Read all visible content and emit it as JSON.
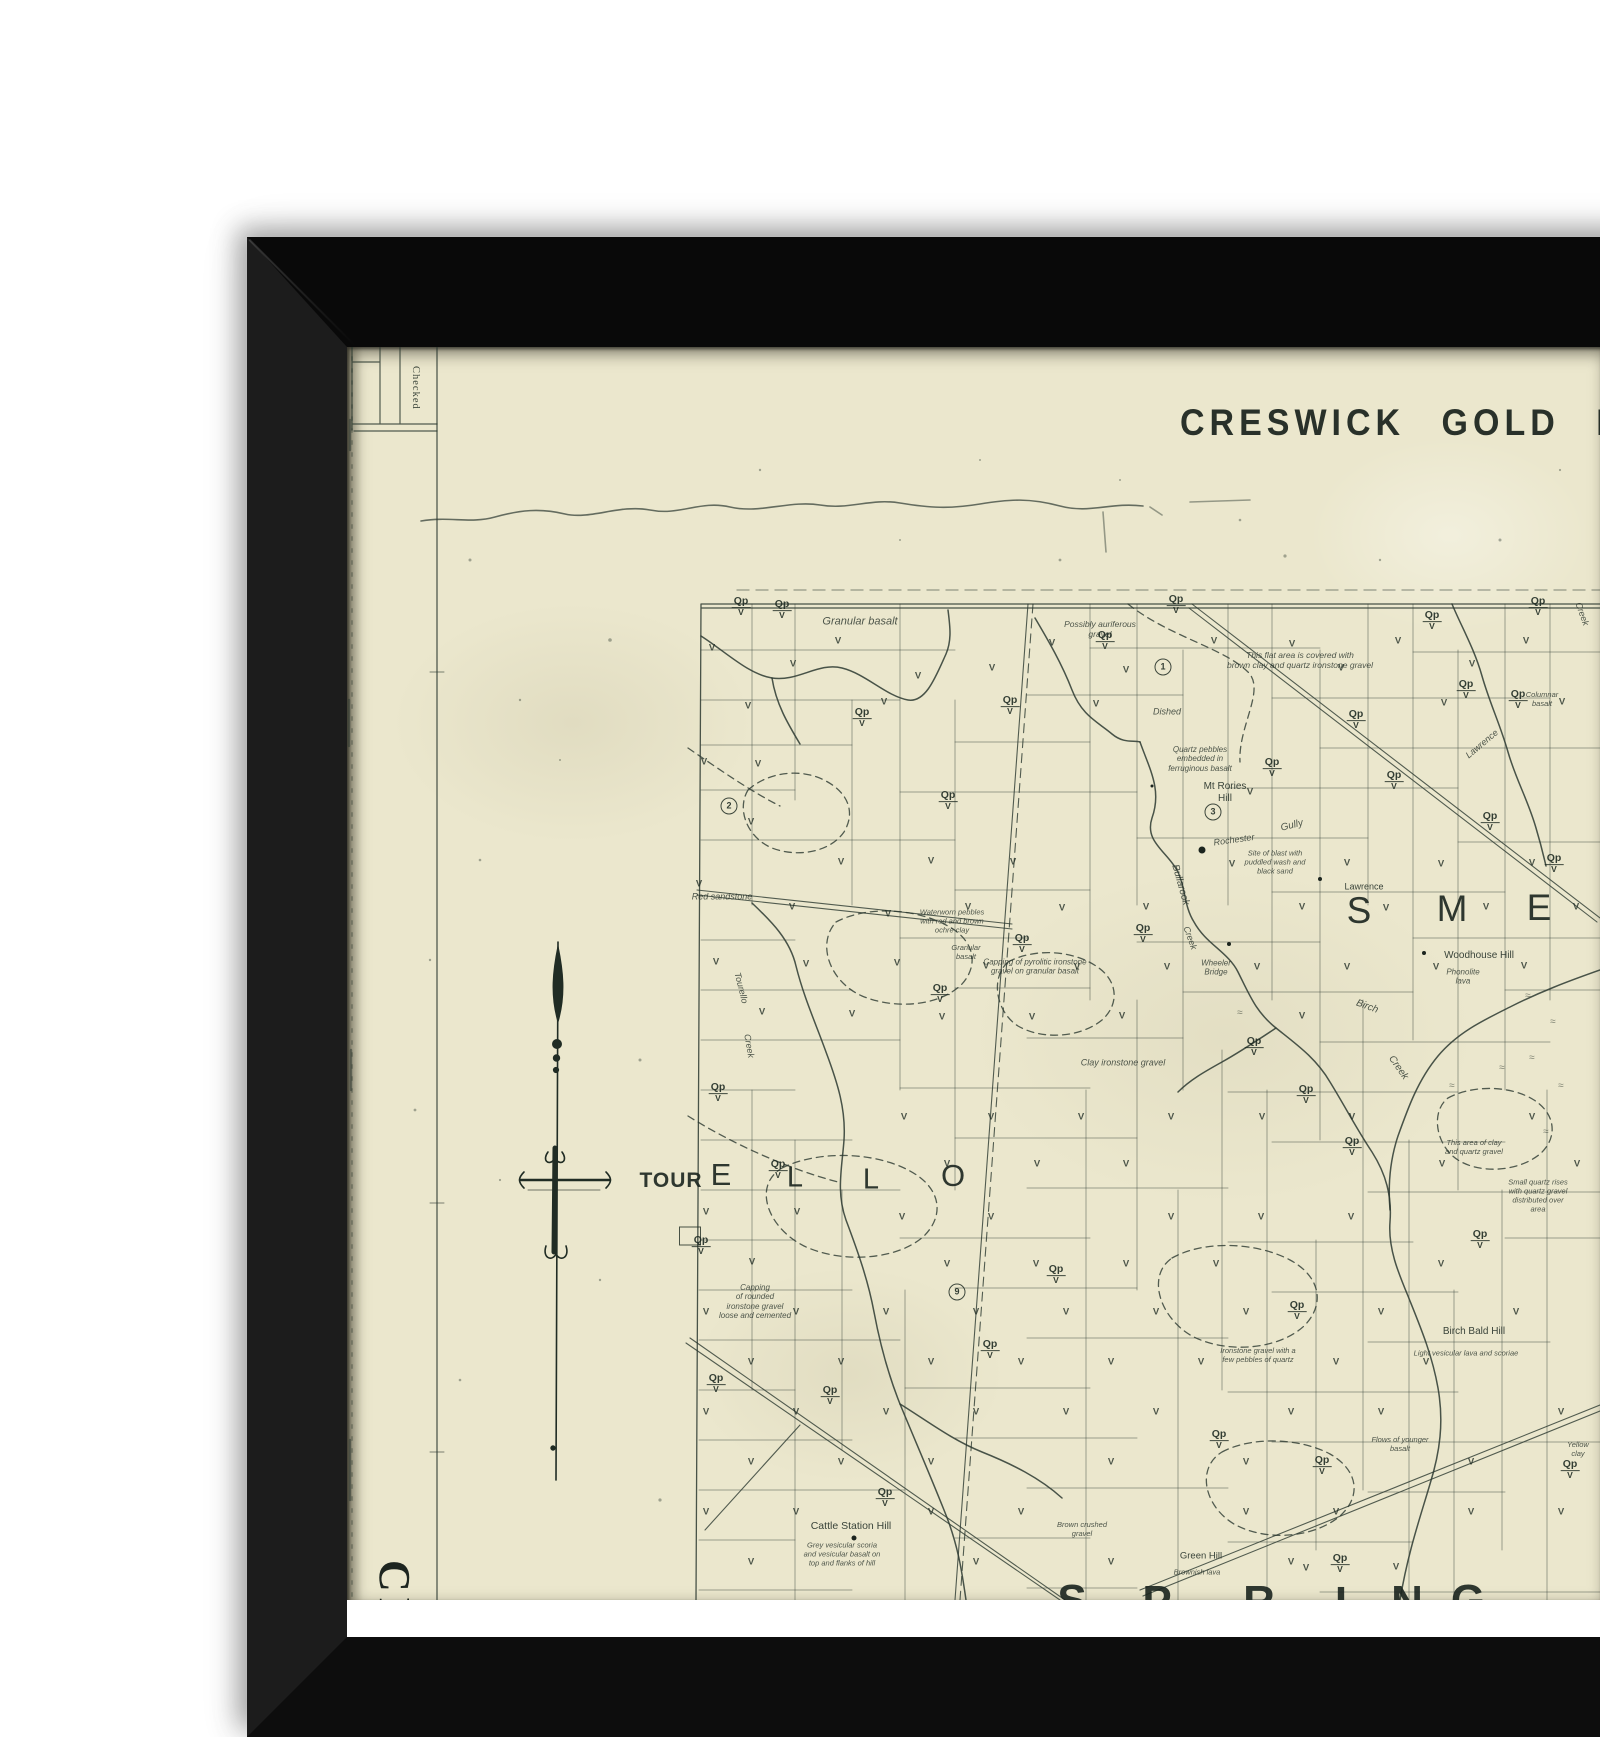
{
  "scene": {
    "background_color": "#ffffff",
    "frame_color": "#0d0d0d",
    "paper_color": "#ebe7cd",
    "ink_color": "#26332a"
  },
  "map": {
    "title": "CRESWICK GOLD FIELD",
    "margin_note": "Checked",
    "vertical_title_fragment": "CR",
    "symbols": {
      "qp_label": "Qp",
      "v_label": "V",
      "marsh_label": "≈",
      "qpv_positions": [
        [
          741,
          607
        ],
        [
          782,
          610
        ],
        [
          1010,
          706
        ],
        [
          1105,
          641
        ],
        [
          1143,
          934
        ],
        [
          862,
          718
        ],
        [
          948,
          801
        ],
        [
          940,
          994
        ],
        [
          1022,
          944
        ],
        [
          1272,
          768
        ],
        [
          1356,
          720
        ],
        [
          1394,
          781
        ],
        [
          1432,
          621
        ],
        [
          1466,
          690
        ],
        [
          1518,
          700
        ],
        [
          1554,
          864
        ],
        [
          1490,
          822
        ],
        [
          1254,
          1047
        ],
        [
          1306,
          1095
        ],
        [
          1352,
          1147
        ],
        [
          1480,
          1240
        ],
        [
          1297,
          1311
        ],
        [
          1219,
          1440
        ],
        [
          1322,
          1466
        ],
        [
          1056,
          1275
        ],
        [
          990,
          1350
        ],
        [
          718,
          1093
        ],
        [
          701,
          1246
        ],
        [
          830,
          1396
        ],
        [
          716,
          1384
        ],
        [
          778,
          1170
        ],
        [
          885,
          1498
        ],
        [
          1340,
          1564
        ],
        [
          1570,
          1470
        ],
        [
          1176,
          605
        ],
        [
          1538,
          607
        ]
      ],
      "v_positions": [
        [
          712,
          648
        ],
        [
          748,
          706
        ],
        [
          793,
          664
        ],
        [
          838,
          641
        ],
        [
          884,
          702
        ],
        [
          918,
          676
        ],
        [
          992,
          668
        ],
        [
          1052,
          643
        ],
        [
          1096,
          704
        ],
        [
          1126,
          670
        ],
        [
          1214,
          641
        ],
        [
          1292,
          644
        ],
        [
          1341,
          668
        ],
        [
          1398,
          641
        ],
        [
          1444,
          703
        ],
        [
          1472,
          664
        ],
        [
          1526,
          641
        ],
        [
          1562,
          702
        ],
        [
          704,
          762
        ],
        [
          758,
          764
        ],
        [
          751,
          822
        ],
        [
          699,
          884
        ],
        [
          792,
          907
        ],
        [
          841,
          862
        ],
        [
          888,
          914
        ],
        [
          931,
          861
        ],
        [
          968,
          907
        ],
        [
          1013,
          862
        ],
        [
          1062,
          908
        ],
        [
          1146,
          907
        ],
        [
          1250,
          792
        ],
        [
          1232,
          864
        ],
        [
          1302,
          907
        ],
        [
          1347,
          863
        ],
        [
          1386,
          908
        ],
        [
          1441,
          864
        ],
        [
          1486,
          907
        ],
        [
          1532,
          863
        ],
        [
          1576,
          907
        ],
        [
          716,
          962
        ],
        [
          762,
          1012
        ],
        [
          806,
          964
        ],
        [
          852,
          1014
        ],
        [
          897,
          963
        ],
        [
          942,
          1017
        ],
        [
          986,
          966
        ],
        [
          1032,
          1017
        ],
        [
          1077,
          967
        ],
        [
          1122,
          1016
        ],
        [
          1167,
          967
        ],
        [
          1257,
          967
        ],
        [
          1302,
          1016
        ],
        [
          1347,
          967
        ],
        [
          1436,
          967
        ],
        [
          1524,
          966
        ],
        [
          904,
          1117
        ],
        [
          947,
          1164
        ],
        [
          991,
          1117
        ],
        [
          1037,
          1164
        ],
        [
          1081,
          1117
        ],
        [
          1126,
          1164
        ],
        [
          1171,
          1117
        ],
        [
          1262,
          1117
        ],
        [
          1352,
          1117
        ],
        [
          1442,
          1164
        ],
        [
          1532,
          1117
        ],
        [
          1577,
          1164
        ],
        [
          706,
          1212
        ],
        [
          752,
          1262
        ],
        [
          797,
          1212
        ],
        [
          902,
          1217
        ],
        [
          947,
          1264
        ],
        [
          991,
          1217
        ],
        [
          1036,
          1264
        ],
        [
          1126,
          1264
        ],
        [
          1171,
          1217
        ],
        [
          1216,
          1264
        ],
        [
          1261,
          1217
        ],
        [
          1351,
          1217
        ],
        [
          1441,
          1264
        ],
        [
          706,
          1312
        ],
        [
          751,
          1362
        ],
        [
          796,
          1312
        ],
        [
          841,
          1362
        ],
        [
          886,
          1312
        ],
        [
          931,
          1362
        ],
        [
          976,
          1312
        ],
        [
          1021,
          1362
        ],
        [
          1066,
          1312
        ],
        [
          1111,
          1362
        ],
        [
          1156,
          1312
        ],
        [
          1201,
          1362
        ],
        [
          1246,
          1312
        ],
        [
          1336,
          1362
        ],
        [
          1381,
          1312
        ],
        [
          1426,
          1362
        ],
        [
          1516,
          1312
        ],
        [
          706,
          1412
        ],
        [
          751,
          1462
        ],
        [
          796,
          1412
        ],
        [
          841,
          1462
        ],
        [
          886,
          1412
        ],
        [
          931,
          1462
        ],
        [
          976,
          1412
        ],
        [
          1066,
          1412
        ],
        [
          1111,
          1462
        ],
        [
          1156,
          1412
        ],
        [
          1246,
          1462
        ],
        [
          1291,
          1412
        ],
        [
          1381,
          1412
        ],
        [
          1471,
          1462
        ],
        [
          1561,
          1412
        ],
        [
          706,
          1512
        ],
        [
          751,
          1562
        ],
        [
          796,
          1512
        ],
        [
          931,
          1512
        ],
        [
          976,
          1562
        ],
        [
          1021,
          1512
        ],
        [
          1111,
          1562
        ],
        [
          1246,
          1512
        ],
        [
          1291,
          1562
        ],
        [
          1336,
          1512
        ],
        [
          1471,
          1512
        ],
        [
          1561,
          1512
        ],
        [
          1396,
          1567
        ],
        [
          1306,
          1568
        ]
      ],
      "marsh_positions": [
        [
          1528,
          996
        ],
        [
          1553,
          1022
        ],
        [
          1532,
          1058
        ],
        [
          1561,
          1086
        ],
        [
          1502,
          1068
        ],
        [
          1546,
          1132
        ],
        [
          1240,
          1013
        ],
        [
          1452,
          1086
        ]
      ]
    },
    "markers": {
      "circled_numbers": [
        {
          "n": "1",
          "x": 1163,
          "y": 667
        },
        {
          "n": "2",
          "x": 729,
          "y": 806
        },
        {
          "n": "3",
          "x": 1213,
          "y": 812
        },
        {
          "n": "9",
          "x": 957,
          "y": 1292
        }
      ],
      "dots": [
        [
          1202,
          850,
          7
        ],
        [
          1320,
          879,
          4
        ],
        [
          1229,
          944,
          4
        ],
        [
          1424,
          953,
          4
        ],
        [
          854,
          1538,
          5
        ],
        [
          1152,
          786,
          3
        ]
      ],
      "boxes": [
        [
          690,
          1236,
          20,
          17
        ]
      ]
    },
    "parish_letters": [
      {
        "ch": "TOUR",
        "x": 671,
        "y": 1181,
        "size": 21,
        "weight": 700,
        "ls": 1
      },
      {
        "ch": "E",
        "x": 721,
        "y": 1175,
        "size": 31,
        "weight": 500,
        "ls": 0
      },
      {
        "ch": "L",
        "x": 795,
        "y": 1178,
        "size": 29,
        "weight": 500,
        "ls": 0
      },
      {
        "ch": "L",
        "x": 871,
        "y": 1180,
        "size": 29,
        "weight": 500,
        "ls": 0
      },
      {
        "ch": "O",
        "x": 953,
        "y": 1176,
        "size": 31,
        "weight": 500,
        "ls": 0
      },
      {
        "ch": "S",
        "x": 1359,
        "y": 911,
        "size": 37,
        "weight": 500,
        "ls": 0
      },
      {
        "ch": "M",
        "x": 1452,
        "y": 909,
        "size": 37,
        "weight": 500,
        "ls": 0
      },
      {
        "ch": "E",
        "x": 1539,
        "y": 908,
        "size": 37,
        "weight": 500,
        "ls": 0
      },
      {
        "ch": "S",
        "x": 1072,
        "y": 1601,
        "size": 44,
        "weight": 600,
        "ls": 0
      },
      {
        "ch": "P",
        "x": 1157,
        "y": 1602,
        "size": 44,
        "weight": 600,
        "ls": 0
      },
      {
        "ch": "R",
        "x": 1259,
        "y": 1602,
        "size": 44,
        "weight": 600,
        "ls": 0
      },
      {
        "ch": "I",
        "x": 1341,
        "y": 1603,
        "size": 44,
        "weight": 600,
        "ls": 0
      },
      {
        "ch": "N",
        "x": 1407,
        "y": 1602,
        "size": 44,
        "weight": 600,
        "ls": 0
      },
      {
        "ch": "G",
        "x": 1468,
        "y": 1601,
        "size": 44,
        "weight": 600,
        "ls": 0
      }
    ],
    "annotations": [
      {
        "text": "Granular basalt",
        "x": 860,
        "y": 622,
        "size": 11,
        "italic": true
      },
      {
        "text": "Possibly auriferous\ngravel",
        "x": 1100,
        "y": 629,
        "size": 8.5,
        "italic": true
      },
      {
        "text": "This flat area is covered with\nbrown clay and quartz ironstone gravel",
        "x": 1300,
        "y": 660,
        "size": 8.5,
        "italic": true
      },
      {
        "text": "Dished",
        "x": 1167,
        "y": 712,
        "size": 9,
        "italic": true
      },
      {
        "text": "Quartz pebbles\nembedded in\nferruginous basalt",
        "x": 1200,
        "y": 759,
        "size": 8,
        "italic": true
      },
      {
        "text": "Mt Rories\nHill",
        "x": 1225,
        "y": 793,
        "size": 10,
        "italic": false
      },
      {
        "text": "Gully",
        "x": 1292,
        "y": 826,
        "size": 10,
        "italic": true,
        "rot": -14
      },
      {
        "text": "Rochester",
        "x": 1234,
        "y": 840,
        "size": 9,
        "italic": true,
        "rot": -8
      },
      {
        "text": "Site of blast with\npuddled wash and\nblack sand",
        "x": 1275,
        "y": 863,
        "size": 7.5,
        "italic": true
      },
      {
        "text": "Lawrence",
        "x": 1364,
        "y": 887,
        "size": 9,
        "italic": false
      },
      {
        "text": "Bullarook",
        "x": 1180,
        "y": 885,
        "size": 10,
        "italic": true,
        "rot": 74
      },
      {
        "text": "Creek",
        "x": 1190,
        "y": 938,
        "size": 9,
        "italic": true,
        "rot": 70
      },
      {
        "text": "Woodhouse Hill",
        "x": 1479,
        "y": 956,
        "size": 10,
        "italic": false
      },
      {
        "text": "Phonolite\nlava",
        "x": 1463,
        "y": 977,
        "size": 8,
        "italic": true
      },
      {
        "text": "Wheeler\nBridge",
        "x": 1216,
        "y": 968,
        "size": 8,
        "italic": true
      },
      {
        "text": "Red sandstone",
        "x": 722,
        "y": 897,
        "size": 9,
        "italic": true
      },
      {
        "text": "Waterworn pebbles\nwith red and brown\nochre clay",
        "x": 952,
        "y": 922,
        "size": 7.5,
        "italic": true
      },
      {
        "text": "Granular\nbasalt",
        "x": 966,
        "y": 953,
        "size": 7.5,
        "italic": true
      },
      {
        "text": "Capping of pyrolitic ironstone\ngravel on granular basalt",
        "x": 1035,
        "y": 967,
        "size": 8,
        "italic": true
      },
      {
        "text": "Clay ironstone gravel",
        "x": 1123,
        "y": 1063,
        "size": 9,
        "italic": true
      },
      {
        "text": "Tourello",
        "x": 741,
        "y": 988,
        "size": 9,
        "italic": true,
        "rot": 76
      },
      {
        "text": "Creek",
        "x": 749,
        "y": 1046,
        "size": 9,
        "italic": true,
        "rot": 80
      },
      {
        "text": "Birch",
        "x": 1367,
        "y": 1007,
        "size": 10,
        "italic": true,
        "rot": 20
      },
      {
        "text": "Creek",
        "x": 1398,
        "y": 1068,
        "size": 10,
        "italic": true,
        "rot": 55
      },
      {
        "text": "This area of clay\nand quartz gravel",
        "x": 1474,
        "y": 1148,
        "size": 7.5,
        "italic": true
      },
      {
        "text": "Small quartz rises\nwith quartz gravel\ndistributed over\narea",
        "x": 1538,
        "y": 1196,
        "size": 7.5,
        "italic": true
      },
      {
        "text": "Birch Bald Hill",
        "x": 1474,
        "y": 1332,
        "size": 10,
        "italic": false
      },
      {
        "text": "Light vesicular lava and scoriae",
        "x": 1466,
        "y": 1354,
        "size": 7.5,
        "italic": true
      },
      {
        "text": "Ironstone gravel with a\nfew pebbles of quartz",
        "x": 1258,
        "y": 1356,
        "size": 7.5,
        "italic": true
      },
      {
        "text": "Flows of younger\nbasalt",
        "x": 1400,
        "y": 1445,
        "size": 7.5,
        "italic": true
      },
      {
        "text": "Yellow clay",
        "x": 1578,
        "y": 1450,
        "size": 7.5,
        "italic": true
      },
      {
        "text": "Capping\nof rounded\nironstone gravel\nloose and cemented",
        "x": 755,
        "y": 1302,
        "size": 8,
        "italic": true
      },
      {
        "text": "Cattle Station Hill",
        "x": 851,
        "y": 1526,
        "size": 10.5,
        "italic": false
      },
      {
        "text": "Grey vesicular scoria\nand vesicular basalt on\ntop and flanks of hill",
        "x": 842,
        "y": 1555,
        "size": 7.5,
        "italic": true
      },
      {
        "text": "Brown crushed\ngravel",
        "x": 1082,
        "y": 1530,
        "size": 7.5,
        "italic": true
      },
      {
        "text": "Green Hill",
        "x": 1201,
        "y": 1556,
        "size": 9.5,
        "italic": false
      },
      {
        "text": "Brownish lava",
        "x": 1197,
        "y": 1573,
        "size": 7.5,
        "italic": true
      },
      {
        "text": "Columnar\nbasalt",
        "x": 1542,
        "y": 700,
        "size": 7.5,
        "italic": true
      },
      {
        "text": "Lawrence",
        "x": 1482,
        "y": 744,
        "size": 9,
        "italic": true,
        "rot": -40
      },
      {
        "text": "Creek",
        "x": 1582,
        "y": 614,
        "size": 9,
        "italic": true,
        "rot": 70
      }
    ]
  }
}
